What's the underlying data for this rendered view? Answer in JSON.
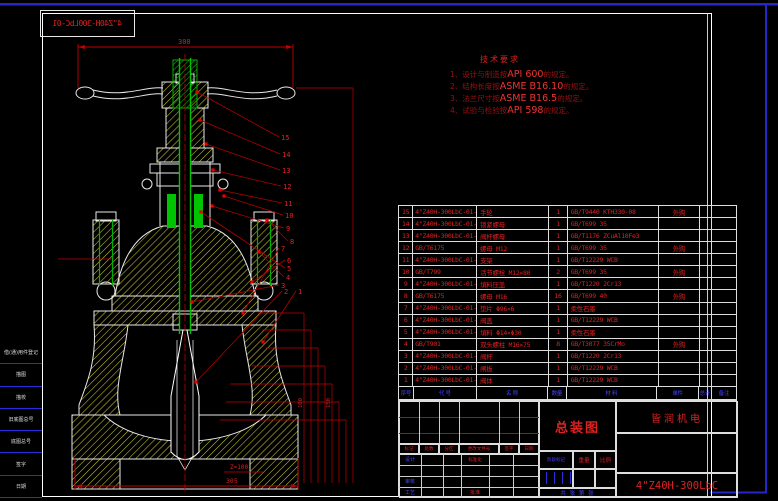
{
  "colors": {
    "dim_red": "#cc0000",
    "hatch_yellow": "#c9c92e",
    "stem_green": "#00c400",
    "frame_blue": "#2626cd",
    "label_blue": "#4444ff",
    "text_red": "#dd2222"
  },
  "mirror_box": {
    "text": "4\"Z40H-300LbC-01"
  },
  "notes": {
    "title": "技术要求",
    "lines": [
      {
        "pre": "1、设计与制造按",
        "std": "API 600",
        "post": "的规定。"
      },
      {
        "pre": "2、结构长度按",
        "std": "ASME B16.10",
        "post": "的规定。"
      },
      {
        "pre": "3、法兰尺寸按",
        "std": "ASME B16.5",
        "post": "的规定。"
      },
      {
        "pre": "4、试验与检验按",
        "std": "API 598",
        "post": "的规定。"
      }
    ]
  },
  "drawing": {
    "dim_top": "300",
    "dim_bottom": "305",
    "dim_side_a": "100",
    "dim_side_b": "150",
    "wedge_note": "Z=100",
    "balloons": [
      "15",
      "14",
      "13",
      "12",
      "11",
      "10",
      "9",
      "8",
      "7",
      "6",
      "5",
      "4",
      "3",
      "2",
      "1"
    ]
  },
  "left_margin": {
    "items": [
      {
        "label": "借(通)用件登记"
      },
      {
        "label": "描图"
      },
      {
        "label": "描校"
      },
      {
        "label": "旧底图总号"
      },
      {
        "label": "底图总号"
      },
      {
        "label": "签字"
      },
      {
        "label": "日期"
      }
    ]
  },
  "bom": {
    "headers": [
      "序号",
      "代 号",
      "名 称",
      "数量",
      "材 料",
      "单件",
      "总计",
      "备注"
    ],
    "rows": [
      {
        "no": "15",
        "code": "4\"Z40H-300LbC-01-12",
        "name": "手轮",
        "qty": "1",
        "material": "GB/T9440 KTH330-08",
        "remark": "外购"
      },
      {
        "no": "14",
        "code": "4\"Z40H-300LbC-01-11",
        "name": "锁紧螺母",
        "qty": "1",
        "material": "GB/T699  35",
        "remark": ""
      },
      {
        "no": "13",
        "code": "4\"Z40H-300LbC-01-10",
        "name": "阀杆螺母",
        "qty": "1",
        "material": "GB/T1176 ZCuAl10Fe3",
        "remark": ""
      },
      {
        "no": "12",
        "code": "GB/T6175",
        "name": "螺母 M12",
        "qty": "1",
        "material": "GB/T699  35",
        "remark": "外购"
      },
      {
        "no": "11",
        "code": "4\"Z40H-300LbC-01-09",
        "name": "支架",
        "qty": "1",
        "material": "GB/T12229 WCB",
        "remark": ""
      },
      {
        "no": "10",
        "code": "GB/T799",
        "name": "活节螺栓 M12×80",
        "qty": "2",
        "material": "GB/T699  35",
        "remark": "外购"
      },
      {
        "no": "9",
        "code": "4\"Z40H-300LbC-01-08",
        "name": "填料压盖",
        "qty": "1",
        "material": "GB/T1220 2Cr13",
        "remark": ""
      },
      {
        "no": "8",
        "code": "GB/T6175",
        "name": "螺母 M16",
        "qty": "16",
        "material": "GB/T699  40",
        "remark": "外购"
      },
      {
        "no": "7",
        "code": "4\"Z40H-300LbC-01-07",
        "name": "垫片 Φ96×6",
        "qty": "1",
        "material": "柔性石墨",
        "remark": ""
      },
      {
        "no": "6",
        "code": "4\"Z40H-300LbC-01-06",
        "name": "阀盖",
        "qty": "1",
        "material": "GB/T12229 WCB",
        "remark": ""
      },
      {
        "no": "5",
        "code": "4\"Z40H-300LbC-01-04",
        "name": "填料 Φ14×Φ30",
        "qty": "1",
        "material": "柔性石墨",
        "remark": ""
      },
      {
        "no": "4",
        "code": "GB/T901",
        "name": "双头螺柱 M16×75",
        "qty": "8",
        "material": "GB/T3077 35CrMo",
        "remark": "外购"
      },
      {
        "no": "3",
        "code": "4\"Z40H-300LbC-01-03",
        "name": "阀杆",
        "qty": "1",
        "material": "GB/T1220 2Cr13",
        "remark": ""
      },
      {
        "no": "2",
        "code": "4\"Z40H-300LbC-01-02",
        "name": "闸板",
        "qty": "1",
        "material": "GB/T12229 WCB",
        "remark": ""
      },
      {
        "no": "1",
        "code": "4\"Z40H-300LbC-01-01",
        "name": "阀体",
        "qty": "1",
        "material": "GB/T12229 WCB",
        "remark": ""
      }
    ]
  },
  "title_block": {
    "rev_headers": [
      "标记",
      "处数",
      "分区",
      "更改文件号",
      "签字",
      "日期"
    ],
    "sig": {
      "design": "设计",
      "standardize": "标准化",
      "check": "审核",
      "process": "工艺",
      "approve": "批准"
    },
    "stage": {
      "stage_mark": "阶段标记",
      "weight": "重量",
      "scale": "比例"
    },
    "sheet_info": "共 张 第 张",
    "drawing_title": "总装图",
    "company": "皆润机电",
    "drawing_no": "4\"Z40H-300LbC"
  }
}
